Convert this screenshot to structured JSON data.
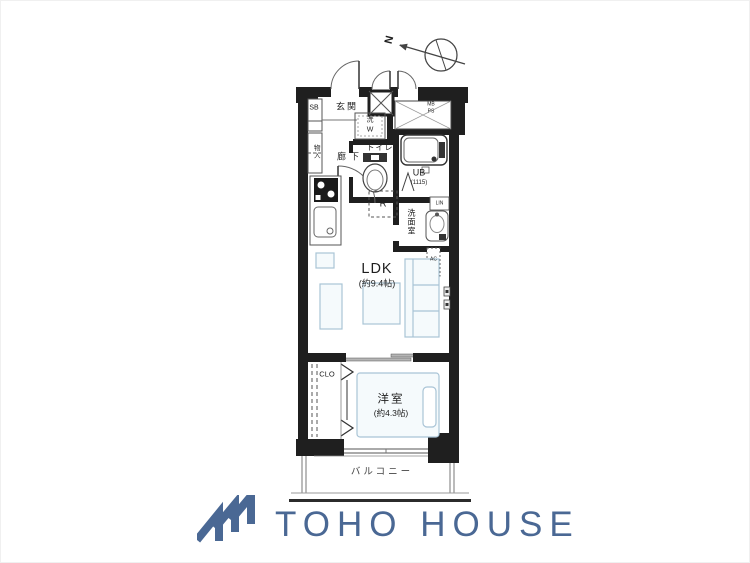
{
  "floor_plan": {
    "compass": {
      "north_label": "N"
    },
    "labels": {
      "entrance": "玄関",
      "shoe_box": "SB",
      "storage": "物入",
      "hallway": "廊下",
      "toilet": "トイレ",
      "unit_bath": "UB",
      "unit_bath_size": "(1115)",
      "washroom": "洗面室",
      "linen": "LIN",
      "refrigerator_space": "R",
      "washer_space_kanji": "洗",
      "washer_space_letter": "W",
      "meter_box": "MB",
      "pipe_space": "PS",
      "ldk": "LDK",
      "ldk_size": "(約9.4帖)",
      "air_conditioner": "AC",
      "closet": "CLO",
      "western_room": "洋室",
      "western_room_size": "(約4.3帖)",
      "balcony": "バルコニー"
    },
    "icons": {
      "compass": "north-compass-arrow-icon",
      "stove": "gas-stove-icon",
      "sink": "kitchen-sink-icon",
      "bathtub": "bathtub-icon",
      "toilet_bowl": "toilet-bowl-icon",
      "washbasin": "washbasin-icon",
      "bed": "bed-icon",
      "sofa": "sofa-icon",
      "table": "table-icon",
      "laundry_hooks": "laundry-pole-bracket-icons"
    },
    "colors": {
      "wall": "#1f1f1f",
      "furniture_line": "#a9c4d6",
      "thin_line": "#555555"
    }
  },
  "branding": {
    "company_name": "TOHO HOUSE",
    "logo_color": "#4a6894"
  }
}
